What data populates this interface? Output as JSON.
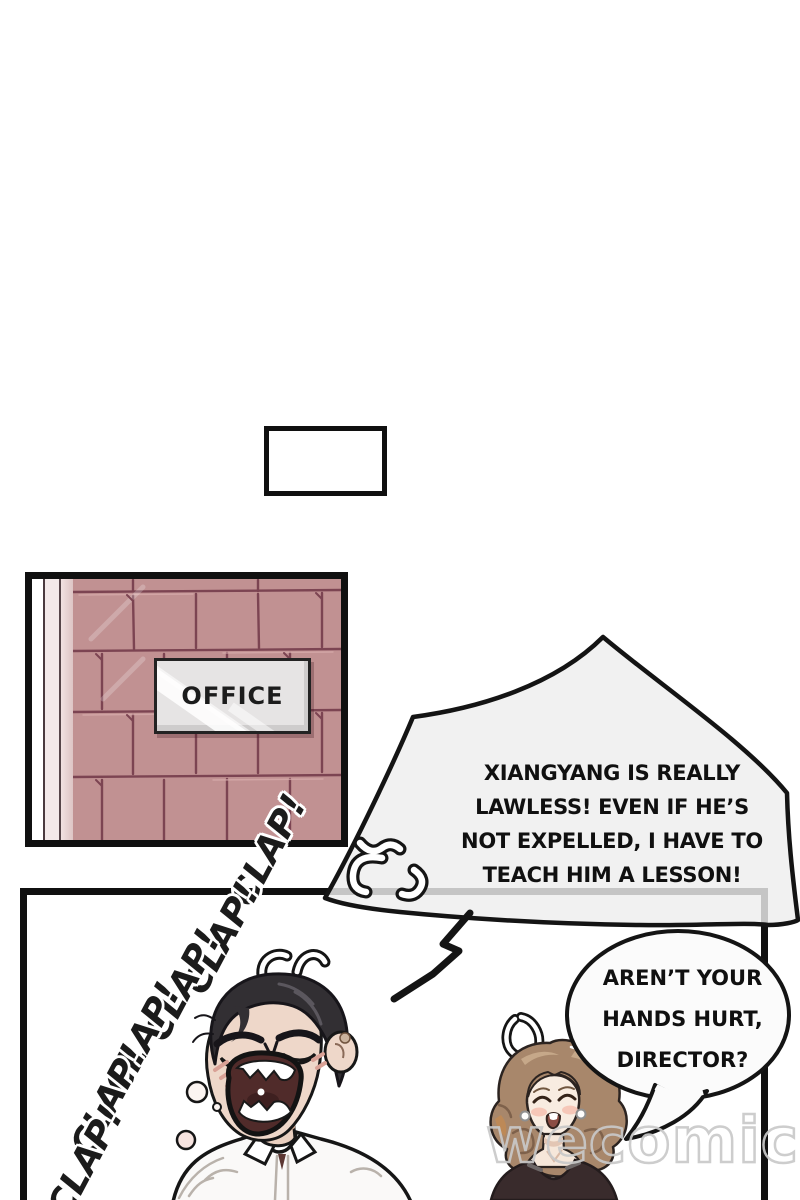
{
  "page": {
    "type": "webtoon-comic-page",
    "background": "#ffffff"
  },
  "office_panel": {
    "sign_text": "OFFICE"
  },
  "sfx": {
    "claps": [
      "CLAP!",
      "CLAP!",
      "CLAP!",
      "CLAP!",
      "CLAP!",
      "CLAP!"
    ]
  },
  "bubbles": {
    "director": {
      "lines": [
        "XIANGYANG IS REALLY",
        "LAWLESS! EVEN IF HE’S",
        "NOT EXPELLED, I HAVE TO",
        "TEACH HIM A LESSON!"
      ]
    },
    "assistant": {
      "lines": [
        "AREN’T YOUR",
        "HANDS HURT,",
        "DIRECTOR?"
      ]
    }
  },
  "watermark": {
    "text": "wecomics"
  },
  "colors": {
    "tile_wall": "#c19192",
    "tile_grout": "#7c4452",
    "sign_bg": "#e6e4e4",
    "spiky_bubble_fill": "#eeeeee",
    "outline": "#141414",
    "man_hair": "#322f33",
    "man_skin": "#eed7c9",
    "mouth_interior": "#502b2a",
    "woman_hair": "#a8876b",
    "woman_top": "#392b2c",
    "watermark_gray": "#c9c9c9"
  }
}
